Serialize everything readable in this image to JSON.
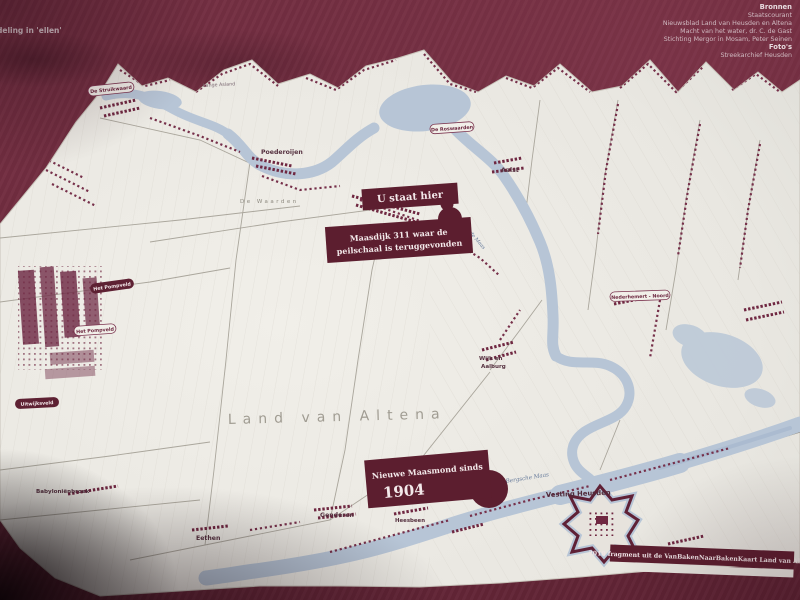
{
  "photo": {
    "board_corner_text": "deling in 'ellen'",
    "credits": {
      "heading_sources": "Bronnen",
      "source_lines": [
        "Staatscourant",
        "Nieuwsblad Land van Heusden en Altena",
        "Macht van het water, dr. C. de Gast",
        "Stichting Mergor in Mosam, Peter Seinen"
      ],
      "heading_photos": "Foto's",
      "photo_lines": [
        "Streekarchief Heusden"
      ]
    }
  },
  "map": {
    "region_title": "Land van Altena",
    "attribution": "2018 fragment uit de VanBakenNaarBakenKaart Land van Altena",
    "callouts": {
      "you_are_here": "U staat hier",
      "maasdijk_line1": "Maasdijk 311 waar de",
      "maasdijk_line2": "peilschaal is teruggevonden",
      "maasmond_line1": "Nieuwe  Maasmond sinds",
      "maasmond_line2": "1904"
    },
    "water_labels": {
      "bergsche_maas": "Bergsche Maas",
      "afgedamde_maas": "Afgedamde Maas"
    },
    "area_labels": {
      "de_waarden": "De Waarden",
      "lange_asland": "Lange Asland"
    },
    "pill_labels": {
      "struikwaard": "De Struikwaard",
      "roswaarden": "De Roswaarden",
      "nederhemert_noord": "Nederhemert - Noord",
      "pompveld_white": "Het Pompveld"
    },
    "dark_pill_labels": {
      "pompveld": "Het Pompveld",
      "uitwijksveld": "Uitwijksveld"
    },
    "town_labels": {
      "poederoijen": "Poederoijen",
      "aalst": "Aalst",
      "wijk_line1": "Wijk en",
      "wijk_line2": "Aalburg",
      "genderen": "Genderen",
      "heesbeen": "Heesbeen",
      "eethen": "Eethen",
      "babylonienbroek": "Babyloniënbroek",
      "vesting_heusden": "Vesting Heusden"
    },
    "colors": {
      "board": "#6e2a3d",
      "callout": "#5c1e2f",
      "water": "#b7c5d6",
      "paper": "#eae8e2",
      "builtup": "#6f2741"
    }
  }
}
